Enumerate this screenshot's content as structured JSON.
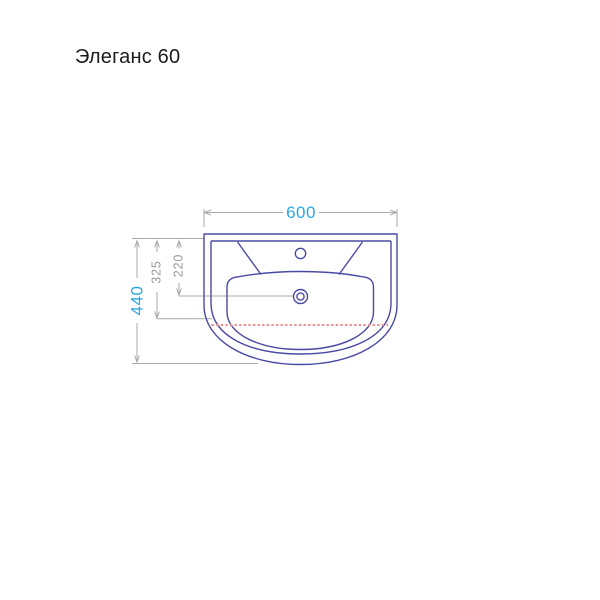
{
  "page": {
    "background": "#ffffff"
  },
  "header": {
    "product_title": "Элеганс 60"
  },
  "diagram": {
    "description": "sink-top-view-technical-drawing",
    "colors": {
      "outline": "#4a4aa5",
      "dimension_lines": "#a9a9a9",
      "dimension_text_accent": "#29a9e0",
      "dimension_text_secondary": "#9a9a9a",
      "overflow_dashed_line": "#ec8f8f"
    },
    "dims": {
      "overall_width": "600",
      "overall_depth": "440",
      "inner_depth": "325",
      "drain_center_depth": "220"
    }
  }
}
